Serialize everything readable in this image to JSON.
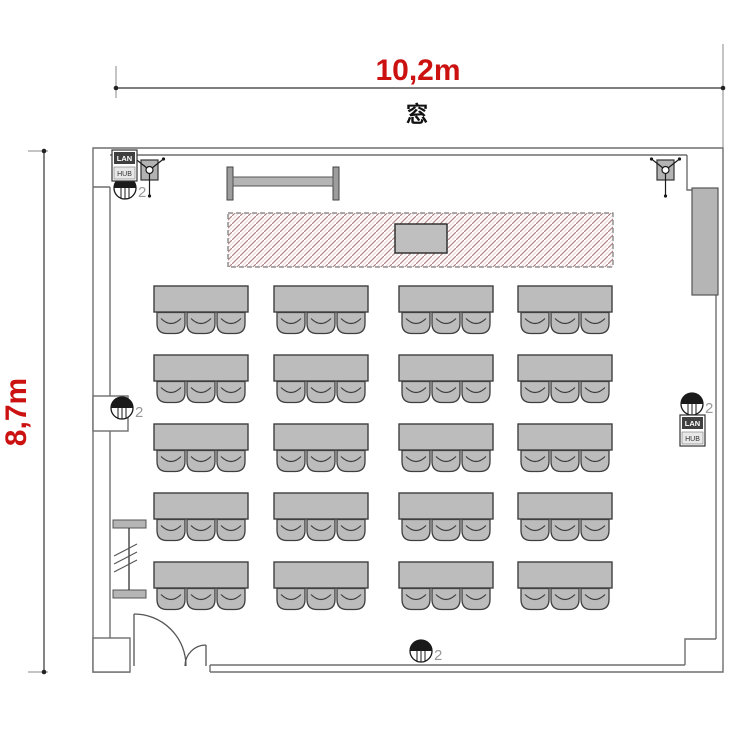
{
  "labels": {
    "width_dimension": "10,2m",
    "height_dimension": "8,7m",
    "window": "窓"
  },
  "colors": {
    "dimension_text": "#cc1111",
    "dimension_line": "#333333",
    "extension_line": "#8a8a8a",
    "wall_line": "#6e6e6e",
    "furniture_fill": "#bcbcbc",
    "furniture_stroke": "#3f3f3f",
    "hatch_line": "#b28585",
    "hatch_line_light": "#e8d2d2",
    "outlet_label": "#999999",
    "symbol_stroke": "#1a1a1a"
  },
  "furniture": {
    "tables": {
      "columns_x": [
        154,
        274,
        399,
        518
      ],
      "rows_y": [
        286,
        355,
        424,
        493,
        562
      ],
      "width": 94,
      "height": 26,
      "chairs_per_table": 3,
      "chair": {
        "width": 28,
        "height": 21,
        "offsets_x": [
          3,
          33,
          63
        ]
      }
    }
  },
  "outlets": [
    {
      "x": 125,
      "y": 188,
      "label": "2"
    },
    {
      "x": 122,
      "y": 408,
      "label": "2"
    },
    {
      "x": 692,
      "y": 404,
      "label": "2"
    },
    {
      "x": 421,
      "y": 651,
      "label": "2"
    }
  ],
  "lan_ports": [
    {
      "x": 112,
      "y": 150,
      "line1": "LAN",
      "line2": "HUB"
    },
    {
      "x": 680,
      "y": 415,
      "line1": "LAN",
      "line2": "HUB"
    }
  ],
  "speakers": [
    {
      "x": 141,
      "y": 160
    },
    {
      "x": 657,
      "y": 160
    }
  ]
}
